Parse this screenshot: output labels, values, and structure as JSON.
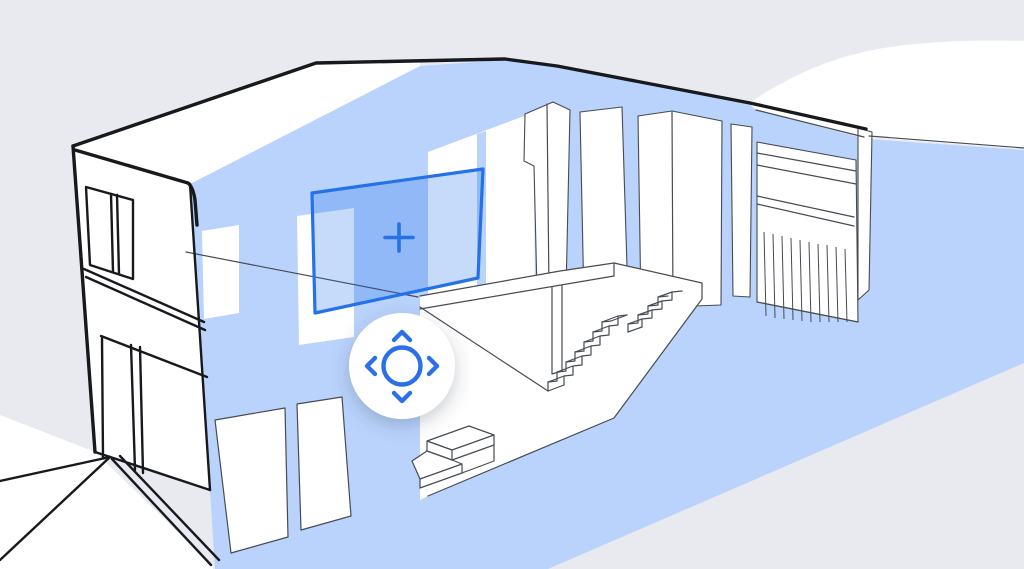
{
  "scene": {
    "background": "#e8eaef",
    "glass_blue": "#b9d3fc",
    "accent_blue": "#2471e8",
    "nav_blue": "#2b70e8",
    "outline_black": "#17191d",
    "detail_gray": "#474b52",
    "surface_white": "#ffffff"
  },
  "illustration": {
    "subject": "cutaway-two-story-house"
  },
  "selection_box": {
    "icon": "plus-icon"
  },
  "nav_pad": {
    "center_icon": "circle-ring-icon",
    "buttons": [
      {
        "icon": "chevron-up-icon"
      },
      {
        "icon": "chevron-right-icon"
      },
      {
        "icon": "chevron-down-icon"
      },
      {
        "icon": "chevron-left-icon"
      }
    ]
  }
}
